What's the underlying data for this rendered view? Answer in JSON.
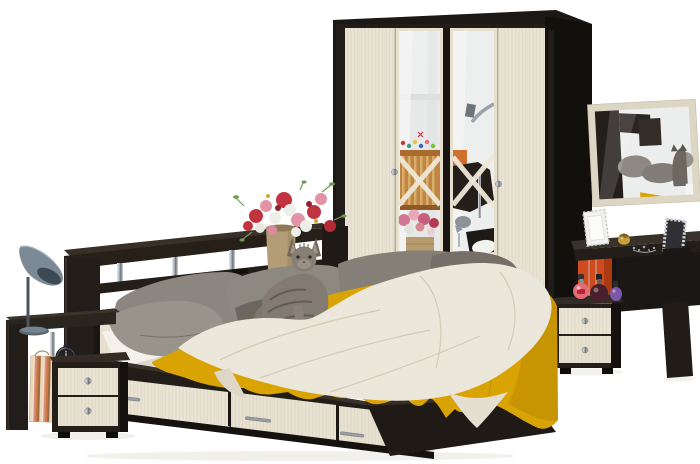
{
  "scene": {
    "description": "Bedroom furniture set product photo on white background",
    "objects": [
      "four-door wardrobe with two mirrored doors",
      "wall mirror in light frame",
      "dressing table",
      "two-drawer vanity pedestal",
      "double bed with three storage drawers",
      "headboard with open shelves on chrome supports",
      "left nightstand with two drawers and lamp shelf",
      "grey desk lamp",
      "black alarm clock",
      "striped gift bag",
      "bouquet of red, pink and white flowers in ceramic vase",
      "grey tabby cat sitting on bed",
      "grey pillows",
      "mustard yellow blanket",
      "cream knitted throw",
      "perfume bottles",
      "two decorative photo frames",
      "gold trinket box and jewelry"
    ]
  },
  "palette": {
    "background": "#ffffff",
    "wenge_dark": "#1c1815",
    "wenge_face": "#221d19",
    "cream_wood": "#e9e3d3",
    "cream_frame": "#ddd6c4",
    "mirror_silver": "#edefee",
    "chrome": "#aab2b8",
    "blanket_yellow": "#d9a303",
    "throw_cream": "#ebe7da",
    "sheet_white": "#f3f1ea",
    "pillow_grey": "#8d8880",
    "cat_grey": "#837b72",
    "lamp_grey": "#7c8a95",
    "orange_accent": "#cf4a1c",
    "vase_tan": "#b29d76",
    "clock_black": "#17171a",
    "flower_red": "#c23340",
    "flower_pink": "#e294a6",
    "flower_white": "#edeee8",
    "leaf_green": "#6f9c52",
    "gift_bag_orange": "#cd7a3a",
    "handle_silver": "#969da3"
  },
  "counts": {
    "wardrobe_doors": 4,
    "mirrored_doors": 2,
    "bed_storage_drawers": 3,
    "left_nightstand_drawers": 2,
    "vanity_pedestal_drawers": 2,
    "perfume_bottles": 3,
    "photo_frames": 2
  }
}
